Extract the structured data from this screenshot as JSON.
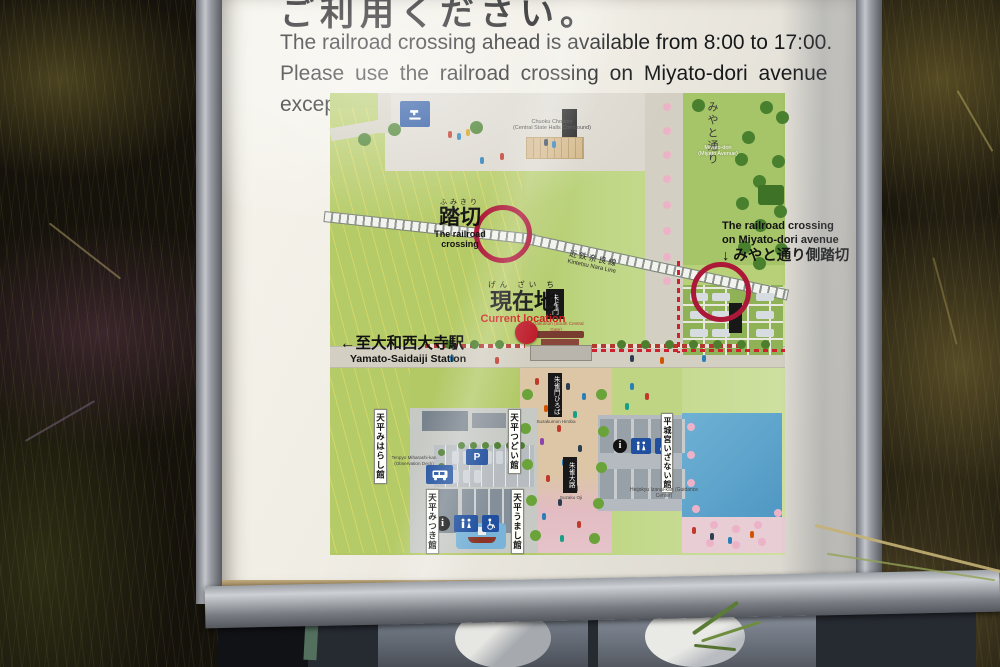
{
  "sign": {
    "heading_jp": "ご利用ください。",
    "notice_lines": [
      "The railroad crossing ahead is available from 8:00 to 17:00.",
      "Please use the railroad crossing on Miyato-dori avenue",
      "except for this period of time."
    ]
  },
  "map": {
    "crossing": {
      "furigana": "ふみきり",
      "jp": "踏切",
      "en": "The railroad crossing"
    },
    "miyato_crossing": {
      "en1": "The railroad crossing",
      "en2": "on Miyato-dori avenue",
      "jp": "↓ みやと通り側踏切"
    },
    "current": {
      "furigana": "げん ざい ち",
      "jp": "現在地",
      "en": "Current location"
    },
    "station": {
      "jp": "←至大和西大寺駅",
      "en": "Yamato-Saidaiji Station"
    },
    "railway": {
      "jp": "近鉄奈良線",
      "en": "Kintetsu Nara Line"
    },
    "miyato_ave": {
      "jp": "みやと通り",
      "en1": "Miyato-dori",
      "en2": "(Miyato Avenue)"
    },
    "chodoin": {
      "en1": "Chuoku Chodoin",
      "en2": "(Central State Halls Compound)"
    },
    "suzakumon": {
      "jp": "朱雀門",
      "en": "Suzakumon (South Central Gate)"
    },
    "suzakumon_square": {
      "jp": "朱雀門ひろば",
      "en": "Suzakumon Hiroba"
    },
    "suzaku_avenue": {
      "jp": "朱雀大路",
      "en": "Suzaku Oji"
    },
    "buildings": {
      "miharashi": {
        "jp": "天平みはらし館",
        "en": "Tenpyo Miharashi-kan (Observation Deck)"
      },
      "tsudoi": {
        "jp": "天平つどい館"
      },
      "mitsuki": {
        "jp": "天平みつき館"
      },
      "umashi": {
        "jp": "天平うまし館"
      },
      "izanai": {
        "jp": "平城宮いざない館",
        "en": "Heijokyu Izanai-kan (Guidance Center)"
      }
    },
    "icons": {
      "parking": "P",
      "info": "i"
    }
  },
  "colors": {
    "ring_red": "#ac1838",
    "route_red": "#cf2030",
    "location_red": "#bf1e2c",
    "sign_blue": "#1f4f9e"
  }
}
